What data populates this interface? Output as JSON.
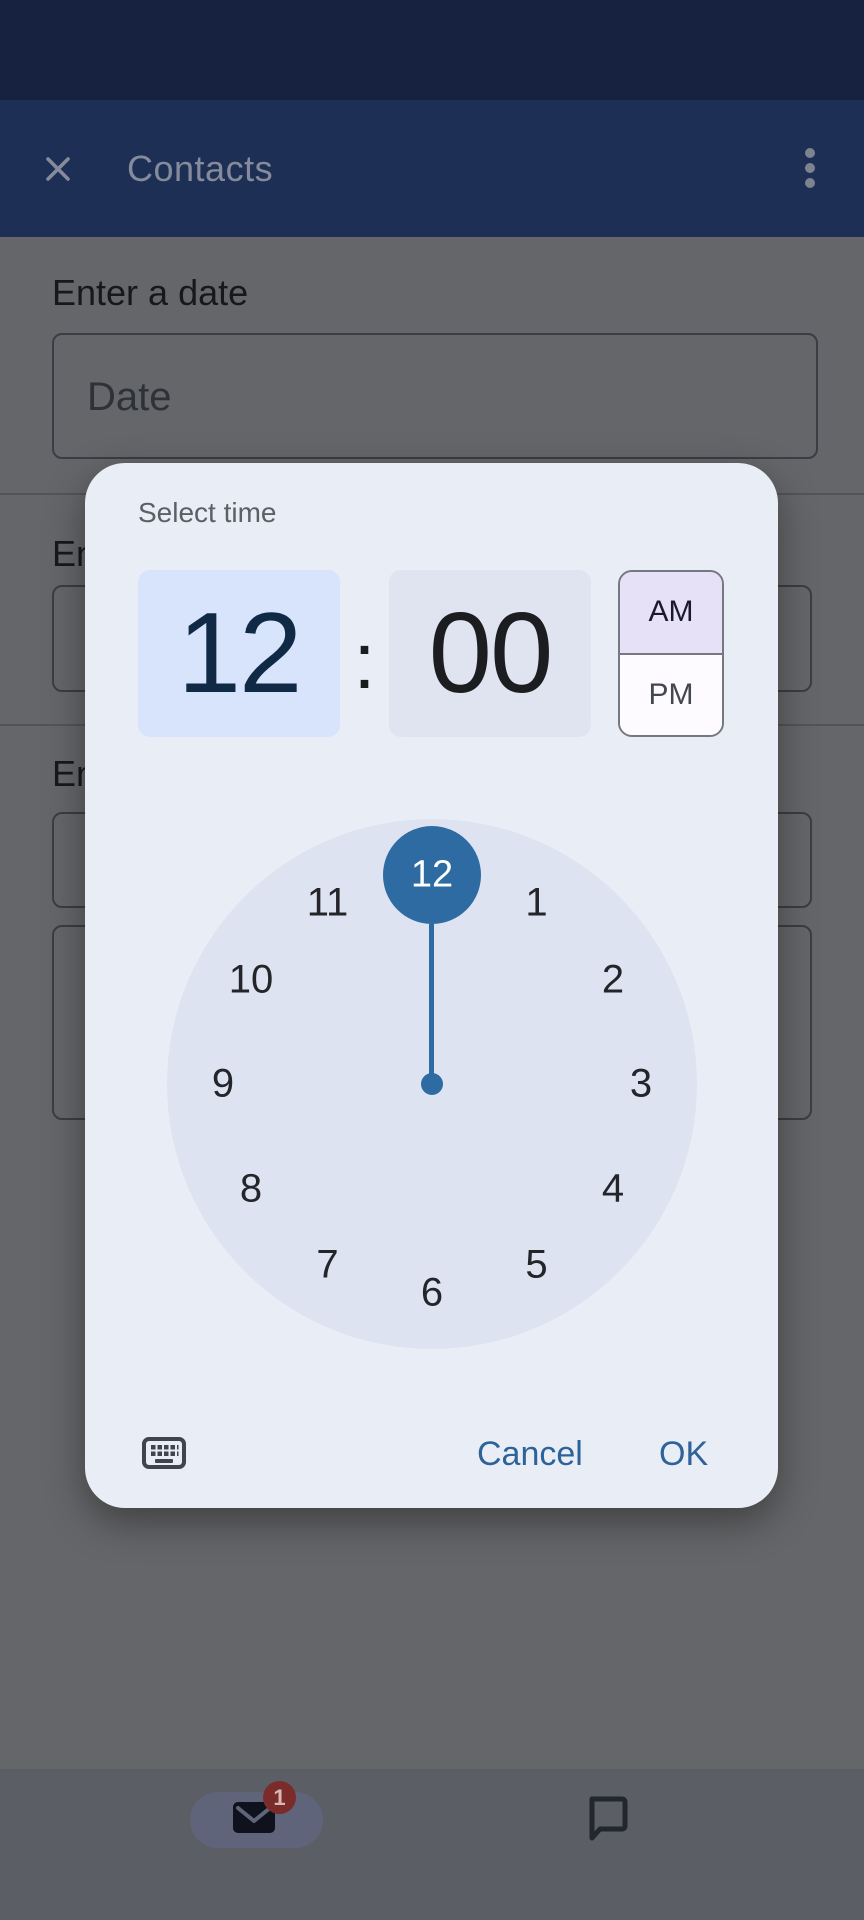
{
  "colors": {
    "status_bar": "#16223f",
    "app_bar": "#1e2f55",
    "app_bar_fg": "#858b9a",
    "scrimmed_background": "#656669",
    "dialog_surface": "#e9eef6",
    "clock_face": "#dde3f0",
    "accent_blue": "#2e6ba2",
    "button_blue": "#2d6398",
    "hour_cell_bg": "#d8e4fb",
    "minute_cell_bg": "#dfe4f0",
    "am_bg": "#e7e1f8",
    "badge_red": "#7b2b2a"
  },
  "app_bar": {
    "title": "Contacts",
    "close_icon": "x-icon",
    "menu_icon": "kebab-menu-icon"
  },
  "form": {
    "date_section": {
      "label": "Enter a date",
      "placeholder": "Date"
    },
    "section2": {
      "label_visible": "En"
    },
    "section3": {
      "label_visible": "En"
    }
  },
  "dialog": {
    "title": "Select time",
    "hour": "12",
    "colon": ":",
    "minute": "00",
    "period": {
      "am": "AM",
      "pm": "PM",
      "selected": "AM"
    },
    "clock": {
      "numbers": [
        "12",
        "1",
        "2",
        "3",
        "4",
        "5",
        "6",
        "7",
        "8",
        "9",
        "10",
        "11"
      ],
      "selected": "12",
      "selected_minute_hand_angle_deg": 0
    },
    "keyboard_icon": "keyboard-icon",
    "cancel_label": "Cancel",
    "ok_label": "OK"
  },
  "bottom_nav": {
    "mail_icon": "mail-icon",
    "mail_badge": "1",
    "chat_icon": "chat-bubble-icon"
  }
}
